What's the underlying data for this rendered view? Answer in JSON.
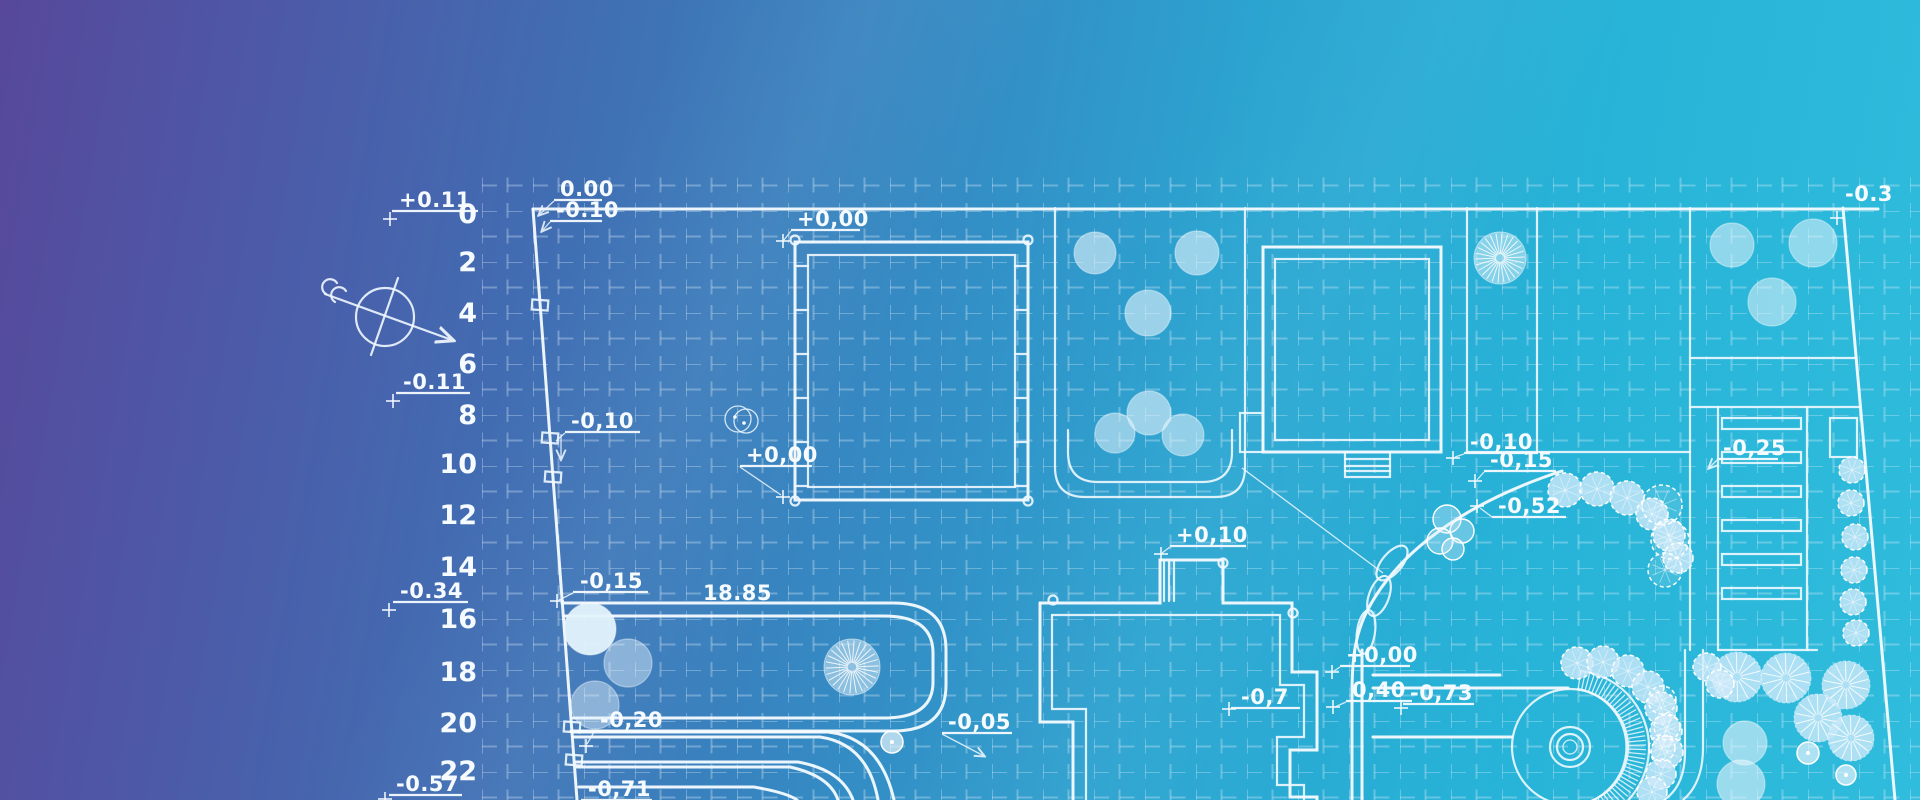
{
  "scene": {
    "width": 1920,
    "height": 800,
    "bg_gradient": [
      "#57489b",
      "#4b5ca9",
      "#4070b4",
      "#3688c2",
      "#2ba5d1",
      "#27b4d8",
      "#30bcdc"
    ],
    "line_color": "#f6fbff",
    "grid_color": "rgba(223,238,250,0.33)"
  },
  "ruler": {
    "x": 477,
    "items": [
      {
        "t": "0",
        "y": 214
      },
      {
        "t": "2",
        "y": 262
      },
      {
        "t": "4",
        "y": 313
      },
      {
        "t": "6",
        "y": 364
      },
      {
        "t": "8",
        "y": 415
      },
      {
        "t": "10",
        "y": 464
      },
      {
        "t": "12",
        "y": 515
      },
      {
        "t": "14",
        "y": 567
      },
      {
        "t": "16",
        "y": 619
      },
      {
        "t": "18",
        "y": 672
      },
      {
        "t": "20",
        "y": 723
      },
      {
        "t": "22",
        "y": 771
      }
    ]
  },
  "labels": [
    {
      "t": "+0.11",
      "x": 399,
      "y": 207,
      "ul": [
        392,
        478,
        211
      ],
      "cross": [
        390,
        219
      ]
    },
    {
      "t": "-0.11",
      "x": 403,
      "y": 389,
      "ul": [
        396,
        470,
        393
      ],
      "cross": [
        393,
        401
      ]
    },
    {
      "t": "-0.34",
      "x": 400,
      "y": 598,
      "ul": [
        393,
        468,
        602
      ],
      "cross": [
        389,
        610
      ]
    },
    {
      "t": "-0.57",
      "x": 396,
      "y": 791,
      "ul": [
        389,
        462,
        795
      ],
      "cross": [
        385,
        799
      ]
    },
    {
      "t": "0.00",
      "x": 560,
      "y": 196,
      "ul": [
        554,
        602,
        200
      ],
      "leader": [
        [
          554,
          201
        ],
        [
          539,
          215
        ]
      ],
      "arrow_end": true
    },
    {
      "t": "-0.10",
      "x": 556,
      "y": 217,
      "ul": [
        550,
        602,
        221
      ],
      "leader": [
        [
          550,
          222
        ],
        [
          542,
          231
        ]
      ],
      "arrow_end": true
    },
    {
      "t": "+0,00",
      "x": 797,
      "y": 226,
      "ul": [
        791,
        860,
        230
      ],
      "leader": [
        [
          791,
          231
        ],
        [
          784,
          240
        ]
      ],
      "cross": [
        783,
        241
      ]
    },
    {
      "t": "-0,10",
      "x": 571,
      "y": 428,
      "ul": [
        565,
        640,
        432
      ],
      "leader": [
        [
          565,
          433
        ],
        [
          556,
          441
        ]
      ],
      "arrow_down": [
        561,
        434,
        459
      ]
    },
    {
      "t": "+0,00",
      "x": 746,
      "y": 462,
      "ul": [
        740,
        812,
        466
      ],
      "leader": [
        [
          740,
          467
        ],
        [
          781,
          495
        ]
      ],
      "cross": [
        783,
        497
      ]
    },
    {
      "t": "-0,15",
      "x": 580,
      "y": 588,
      "ul": [
        573,
        648,
        592
      ],
      "leader": [
        [
          573,
          593
        ],
        [
          559,
          600
        ]
      ],
      "cross": [
        557,
        601
      ]
    },
    {
      "t": "-0,20",
      "x": 600,
      "y": 727,
      "ul": [
        594,
        662,
        731
      ],
      "leader": [
        [
          594,
          732
        ],
        [
          587,
          744
        ]
      ],
      "cross": [
        586,
        746
      ]
    },
    {
      "t": "-0,71",
      "x": 588,
      "y": 796,
      "ul": [
        581,
        652,
        800
      ]
    },
    {
      "t": "-0,05",
      "x": 948,
      "y": 729,
      "ul": [
        942,
        1012,
        733
      ],
      "leader": [
        [
          942,
          734
        ],
        [
          984,
          756
        ]
      ],
      "arrow_end": true
    },
    {
      "t": "+0,10",
      "x": 1176,
      "y": 542,
      "ul": [
        1170,
        1246,
        546
      ],
      "leader": [
        [
          1170,
          547
        ],
        [
          1162,
          553
        ]
      ],
      "cross": [
        1161,
        554
      ]
    },
    {
      "t": "-0,7",
      "x": 1241,
      "y": 704,
      "ul": [
        1231,
        1300,
        708
      ],
      "cross": [
        1229,
        709
      ]
    },
    {
      "t": "+0,00",
      "x": 1346,
      "y": 662,
      "ul": [
        1340,
        1410,
        666
      ],
      "leader": [
        [
          1340,
          667
        ],
        [
          1334,
          671
        ]
      ],
      "cross": [
        1332,
        672
      ]
    },
    {
      "t": "0,40",
      "x": 1352,
      "y": 697,
      "ul": [
        1346,
        1412,
        701
      ],
      "leader": [
        [
          1346,
          702
        ],
        [
          1335,
          707
        ]
      ],
      "cross": [
        1333,
        707
      ]
    },
    {
      "t": "-0,73",
      "x": 1410,
      "y": 700,
      "ul": [
        1403,
        1474,
        704
      ],
      "cross": [
        1401,
        708
      ]
    },
    {
      "t": "-0,10",
      "x": 1470,
      "y": 449,
      "ul": [
        1464,
        1538,
        453
      ],
      "leader": [
        [
          1464,
          454
        ],
        [
          1455,
          457
        ]
      ],
      "cross": [
        1453,
        458
      ]
    },
    {
      "t": "-0,15",
      "x": 1490,
      "y": 467,
      "ul": [
        1484,
        1556,
        471
      ],
      "leader": [
        [
          1484,
          472
        ],
        [
          1477,
          480
        ]
      ],
      "cross": [
        1475,
        481
      ]
    },
    {
      "t": "-0,52",
      "x": 1498,
      "y": 513,
      "ul": [
        1492,
        1566,
        517
      ],
      "leader": [
        [
          1492,
          517
        ],
        [
          1480,
          508
        ]
      ],
      "cross": [
        1477,
        506
      ]
    },
    {
      "t": "-0,25",
      "x": 1723,
      "y": 455,
      "ul": [
        1717,
        1778,
        459
      ],
      "leader": [
        [
          1717,
          460
        ],
        [
          1709,
          468
        ]
      ],
      "arrow_end": true
    },
    {
      "t": "-0.3",
      "x": 1845,
      "y": 201,
      "cross": [
        1837,
        218
      ]
    }
  ],
  "dims": [
    {
      "t": "18.85",
      "x": 703,
      "y": 600
    }
  ],
  "compass": {
    "cx": 385,
    "cy": 317,
    "r": 29,
    "arrow": [
      325,
      294,
      452,
      340
    ],
    "cross_line": [
      398,
      278,
      371,
      355
    ],
    "tail": "M 337,283 a 8,8 0 1 0 -11,11 M 346,291 a 8,8 0 1 0 -11,11"
  },
  "plan": {
    "outline": [
      {
        "d": "M 533,209 H 1878",
        "w": 3.4
      },
      {
        "d": "M 533,209 L 577,800",
        "w": 3
      },
      {
        "d": "M 1843,208 L 1895,800",
        "w": 3
      }
    ],
    "boundary_markers": [
      {
        "x": 540,
        "y": 305
      },
      {
        "x": 550,
        "y": 438
      },
      {
        "x": 553,
        "y": 477
      },
      {
        "x": 572,
        "y": 727
      },
      {
        "x": 574,
        "y": 760
      }
    ],
    "parcels": [
      "M 1055,208 V 467 Q 1055,497 1085,497 L 1215,497 Q 1245,497 1245,467 L 1245,208",
      "M 1068,430 V 452 Q 1068,482 1098,482 H 1202 Q 1232,482 1232,452 V 430",
      "M 1467,208 V 452",
      "M 1537,208 V 452",
      "M 1467,452 H 1690",
      "M 1690,208 V 650",
      "M 1690,358 H 1856",
      "M 1685,650 V 752 Q 1685,786 1664,800",
      "M 1703,650 V 748 Q 1703,783 1683,800"
    ],
    "roads": [
      {
        "d": "M 562,603 H 893 Q 946,603 946,650 V 685 Q 946,731 893,731 H 571",
        "w": 3
      },
      {
        "d": "M 564,616 H 884 Q 933,616 933,653 V 682 Q 933,718 884,718 H 573",
        "w": 2
      },
      {
        "d": "M 572,732 H 828 Q 880,738 894,800",
        "w": 2.6
      },
      {
        "d": "M 573,737 H 820 Q 868,744 878,800",
        "w": 2
      },
      {
        "d": "M 576,762 H 798 Q 842,770 853,800",
        "w": 2.6
      },
      {
        "d": "M 577,767 H 790 Q 830,776 838,800",
        "w": 2
      },
      {
        "d": "M 579,787 H 754 Q 788,793 797,800",
        "w": 2.2
      },
      {
        "d": "M 1562,471 C 1470,501 1399,549 1367,611 C 1355,635 1352,659 1352,694 L 1352,800",
        "w": 3
      },
      {
        "d": "M 1362,650 V 800",
        "w": 2
      },
      {
        "d": "M 1373,675 H 1500",
        "w": 2.2
      },
      {
        "d": "M 1373,688 H 1568",
        "w": 2.2
      },
      {
        "d": "M 1373,737 H 1512",
        "w": 2.2
      }
    ],
    "bumps": [
      {
        "cx": 1392,
        "cy": 563,
        "rx": 10,
        "ry": 21,
        "rot": 40
      },
      {
        "cx": 1379,
        "cy": 596,
        "rx": 10,
        "ry": 21,
        "rot": 20
      },
      {
        "cx": 1366,
        "cy": 632,
        "rx": 9,
        "ry": 22,
        "rot": 8
      }
    ],
    "thin_leaders": [
      "M 1242,468 L 1383,573"
    ],
    "buildings": {
      "square": {
        "outer": [
          795,
          242,
          233,
          258
        ],
        "inner": [
          808,
          255,
          207,
          232
        ],
        "corner_circles": [
          [
            795,
            240
          ],
          [
            1028,
            240
          ],
          [
            795,
            501
          ],
          [
            1028,
            501
          ]
        ],
        "tick_y": [
          266,
          310,
          354,
          398,
          442,
          486
        ]
      },
      "upper_right": {
        "outer": [
          1263,
          247,
          178,
          205
        ],
        "inner": [
          1275,
          259,
          154,
          181
        ],
        "annex": [
          1240,
          413,
          23,
          39
        ],
        "stairs": {
          "rect": [
            1345,
            452,
            45,
            25
          ],
          "lines_y": [
            459,
            466,
            471
          ]
        }
      },
      "lower": {
        "outer_paths": [
          "M 1040,603 L 1160,603 L 1160,560 L 1223,560 L 1223,603 L 1292,603 L 1292,672 L 1317,672 L 1317,750 L 1290,750 L 1290,797 L 1317,797 L 1317,800",
          "M 1040,603 L 1040,722 L 1073,722 L 1073,800"
        ],
        "inner_paths": [
          "M 1052,615 H 1280 V 685 H 1304 V 737 H 1277 V 785 H 1304 V 800",
          "M 1052,615 V 709 H 1086 V 800"
        ],
        "porch_lines_x": [
          1164,
          1169,
          1174
        ],
        "porch_lines_y": [
          562,
          601
        ],
        "corner_circles": [
          [
            1053,
            600
          ],
          [
            1293,
            613
          ],
          [
            1223,
            563
          ]
        ]
      }
    },
    "roundabout": {
      "cx": 1570,
      "cy": 747,
      "rings": [
        20,
        13
      ],
      "dot_r": 7,
      "inner_r": 58,
      "outer_r": 77,
      "hatch": {
        "r1": 59,
        "r2": 76,
        "a1": -82,
        "a2": 94,
        "step": 3.5
      },
      "arcs": [
        "M 1581,671 A 77 77 0 0 1 1563,824",
        "M 1578,689 A 59 59 0 0 1 1565,806"
      ]
    },
    "parking": {
      "frame": [
        "M 1690,407 H 1860",
        "M 1718,407 V 650",
        "M 1807,407 V 650",
        "M 1718,650 H 1817"
      ],
      "bar_x": 1722,
      "bar_w": 79,
      "bar_h": 11,
      "bar_y0": 418,
      "bar_step": 34,
      "bar_count": 6,
      "side_rect": [
        1830,
        418,
        27,
        39
      ]
    },
    "manhole": {
      "c1": [
        738,
        419,
        13
      ],
      "c2": [
        746,
        421,
        12
      ],
      "dots": [
        [
          735,
          417
        ],
        [
          744,
          423
        ]
      ]
    },
    "trees": [
      {
        "type": "solid",
        "x": 1095,
        "y": 253,
        "r": 21,
        "a": 0.6
      },
      {
        "type": "solid",
        "x": 1197,
        "y": 253,
        "r": 22,
        "a": 0.6
      },
      {
        "type": "solid",
        "x": 1148,
        "y": 313,
        "r": 23,
        "a": 0.6
      },
      {
        "type": "solid",
        "x": 1149,
        "y": 413,
        "r": 22,
        "a": 0.6
      },
      {
        "type": "solid",
        "x": 1115,
        "y": 433,
        "r": 20,
        "a": 0.55
      },
      {
        "type": "solid",
        "x": 1183,
        "y": 435,
        "r": 21,
        "a": 0.55
      },
      {
        "type": "solid",
        "x": 1732,
        "y": 245,
        "r": 22,
        "a": 0.55
      },
      {
        "type": "solid",
        "x": 1813,
        "y": 243,
        "r": 24,
        "a": 0.55
      },
      {
        "type": "solid",
        "x": 1772,
        "y": 302,
        "r": 24,
        "a": 0.55
      },
      {
        "type": "solid",
        "x": 590,
        "y": 629,
        "r": 26,
        "a": 0.95
      },
      {
        "type": "solid",
        "x": 628,
        "y": 663,
        "r": 24,
        "a": 0.45
      },
      {
        "type": "solid",
        "x": 595,
        "y": 705,
        "r": 24,
        "a": 0.45
      },
      {
        "type": "solid",
        "x": 1745,
        "y": 743,
        "r": 22,
        "a": 0.6
      },
      {
        "type": "solid",
        "x": 1741,
        "y": 784,
        "r": 24,
        "a": 0.6
      },
      {
        "type": "sunburst",
        "x": 852,
        "y": 667,
        "r": 28
      },
      {
        "type": "sunburst",
        "x": 1500,
        "y": 258,
        "r": 26
      },
      {
        "type": "fan",
        "x": 1737,
        "y": 677,
        "r": 25
      },
      {
        "type": "fan",
        "x": 1786,
        "y": 678,
        "r": 25
      },
      {
        "type": "fan",
        "x": 1846,
        "y": 685,
        "r": 24
      },
      {
        "type": "fan",
        "x": 1818,
        "y": 718,
        "r": 24
      },
      {
        "type": "fan",
        "x": 1851,
        "y": 738,
        "r": 23
      },
      {
        "type": "fluffy",
        "x": 1565,
        "y": 490,
        "r": 17
      },
      {
        "type": "fluffy",
        "x": 1597,
        "y": 489,
        "r": 17
      },
      {
        "type": "fluffy",
        "x": 1627,
        "y": 498,
        "r": 17
      },
      {
        "type": "fluffy",
        "x": 1652,
        "y": 514,
        "r": 16
      },
      {
        "type": "fluffy",
        "x": 1669,
        "y": 535,
        "r": 16
      },
      {
        "type": "fluffy",
        "x": 1678,
        "y": 558,
        "r": 15
      },
      {
        "type": "fluffy",
        "x": 1577,
        "y": 663,
        "r": 16
      },
      {
        "type": "fluffy",
        "x": 1603,
        "y": 662,
        "r": 16
      },
      {
        "type": "fluffy",
        "x": 1628,
        "y": 671,
        "r": 16
      },
      {
        "type": "fluffy",
        "x": 1648,
        "y": 687,
        "r": 16
      },
      {
        "type": "fluffy",
        "x": 1661,
        "y": 708,
        "r": 16
      },
      {
        "type": "fluffy",
        "x": 1666,
        "y": 731,
        "r": 16
      },
      {
        "type": "fluffy",
        "x": 1667,
        "y": 752,
        "r": 16
      },
      {
        "type": "fluffy",
        "x": 1661,
        "y": 774,
        "r": 15
      },
      {
        "type": "fluffy",
        "x": 1652,
        "y": 792,
        "r": 15
      },
      {
        "type": "fluffy",
        "x": 1707,
        "y": 667,
        "r": 14
      },
      {
        "type": "fluffy",
        "x": 1720,
        "y": 684,
        "r": 14
      },
      {
        "type": "fluffy",
        "x": 1852,
        "y": 470,
        "r": 13
      },
      {
        "type": "fluffy",
        "x": 1851,
        "y": 503,
        "r": 13
      },
      {
        "type": "fluffy",
        "x": 1855,
        "y": 537,
        "r": 13
      },
      {
        "type": "fluffy",
        "x": 1854,
        "y": 570,
        "r": 13
      },
      {
        "type": "fluffy",
        "x": 1853,
        "y": 602,
        "r": 13
      },
      {
        "type": "fluffy",
        "x": 1856,
        "y": 633,
        "r": 13
      },
      {
        "type": "wfluffy",
        "x": 1662,
        "y": 505,
        "r": 20
      },
      {
        "type": "wfluffy",
        "x": 1670,
        "y": 540,
        "r": 19
      },
      {
        "type": "wfluffy",
        "x": 1665,
        "y": 570,
        "r": 17
      },
      {
        "type": "wfluffy",
        "x": 1662,
        "y": 700,
        "r": 14
      },
      {
        "type": "wfluffy",
        "x": 1667,
        "y": 727,
        "r": 13
      },
      {
        "type": "wfluffy",
        "x": 1662,
        "y": 748,
        "r": 13
      },
      {
        "type": "outline",
        "x": 1447,
        "y": 519,
        "r": 14
      },
      {
        "type": "outline",
        "x": 1462,
        "y": 531,
        "r": 12
      },
      {
        "type": "outline",
        "x": 1440,
        "y": 541,
        "r": 13
      },
      {
        "type": "outline",
        "x": 1453,
        "y": 549,
        "r": 11
      },
      {
        "type": "dotted",
        "x": 892,
        "y": 742,
        "r": 11
      },
      {
        "type": "dotted",
        "x": 1808,
        "y": 753,
        "r": 11
      },
      {
        "type": "dotted",
        "x": 1846,
        "y": 775,
        "r": 10
      }
    ]
  }
}
